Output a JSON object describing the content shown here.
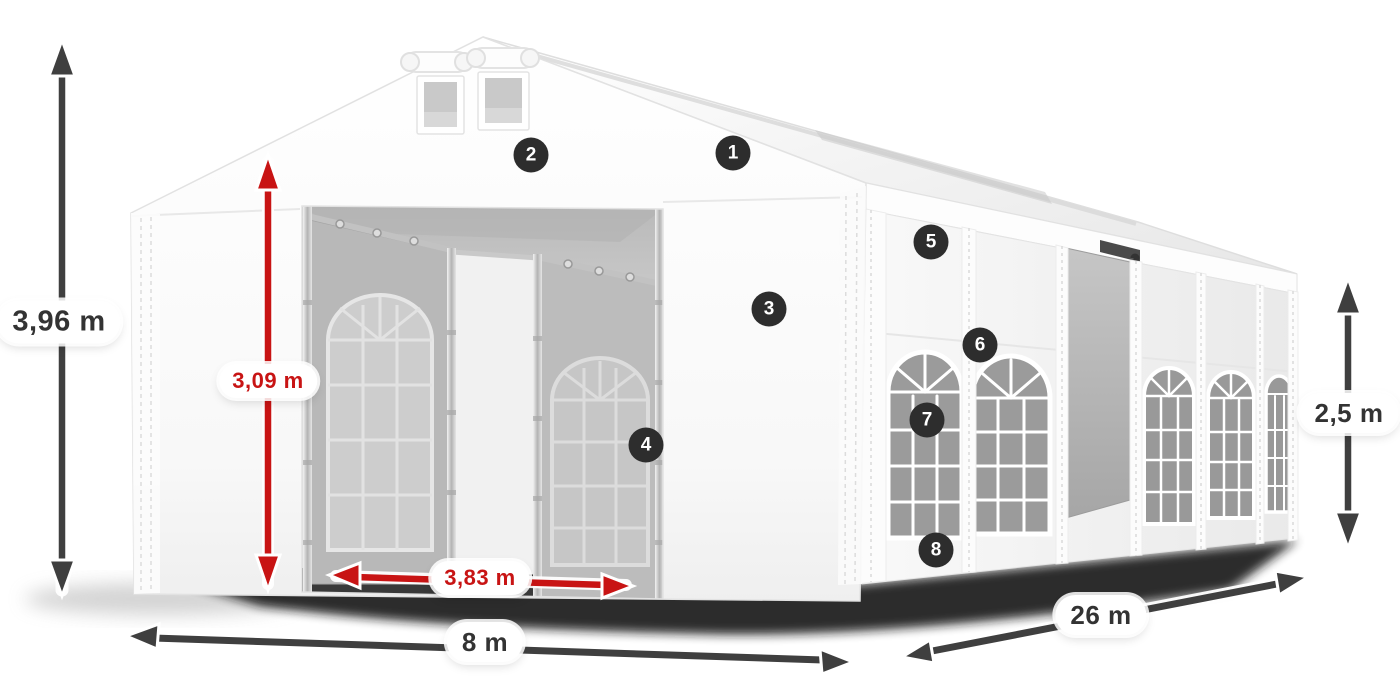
{
  "diagram": {
    "dimension_labels": {
      "total_height": "3,96 m",
      "entrance_height": "3,09 m",
      "entrance_width": "3,83 m",
      "front_width": "8 m",
      "side_length": "26 m",
      "side_height": "2,5 m"
    },
    "markers": [
      "1",
      "2",
      "3",
      "4",
      "5",
      "6",
      "7",
      "8"
    ],
    "colors": {
      "red": "#c81414",
      "dark": "#3f3f3f",
      "badge": "#2d2d2d",
      "dark_text": "#333333"
    }
  }
}
